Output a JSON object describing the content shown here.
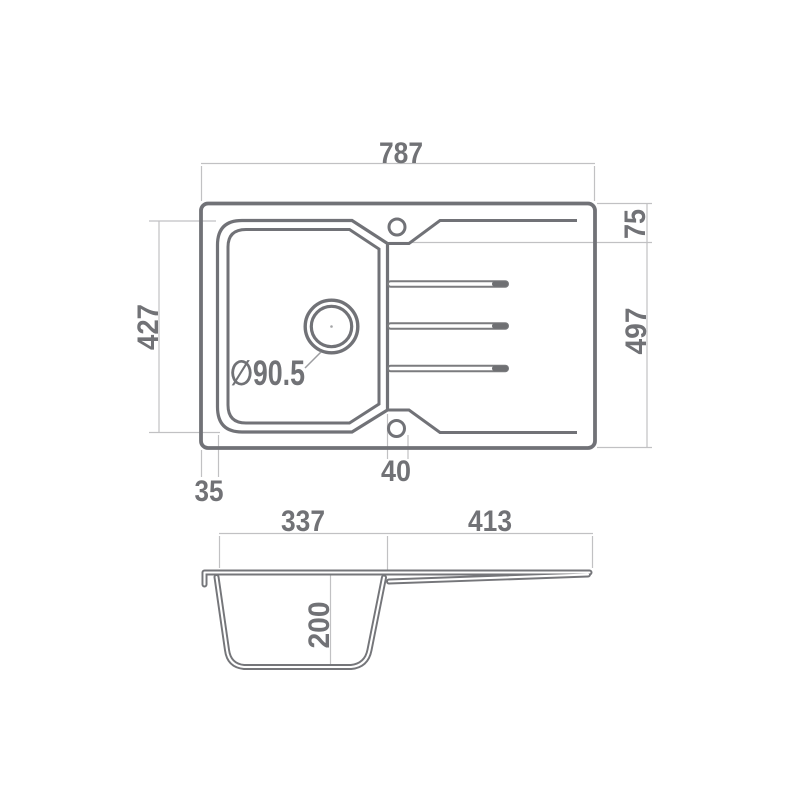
{
  "title": "Kitchen sink technical drawing",
  "colors": {
    "background": "#ffffff",
    "main_line": "#717277",
    "dimension_line": "#c1c1c3",
    "text": "#717276"
  },
  "plan_view": {
    "overall_width": "787",
    "rim_top_offset": "75",
    "bowl_length": "427",
    "overall_depth": "497",
    "bowl_left_offset": "35",
    "tap_ledge_width": "40",
    "drain_diameter": "∅90.5"
  },
  "section_view": {
    "bowl_width": "337",
    "drainboard_width": "413",
    "bowl_depth": "200"
  }
}
